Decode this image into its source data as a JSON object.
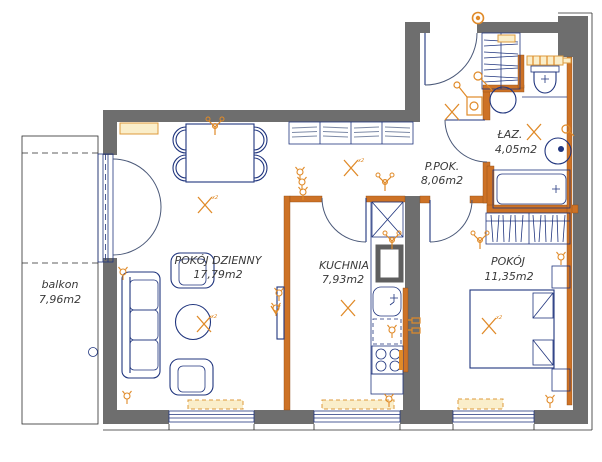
{
  "plan": {
    "title": "apartment-floor-plan",
    "rooms": [
      {
        "name": "POKÓJ DZIENNY",
        "area": "17,79m2"
      },
      {
        "name": "KUCHNIA",
        "area": "7,93m2"
      },
      {
        "name": "P.POK.",
        "area": "8,06m2"
      },
      {
        "name": "ŁAZ.",
        "area": "4,05m2"
      },
      {
        "name": "POKÓJ",
        "area": "11,35m2"
      },
      {
        "name": "balkon",
        "area": "7,96m2"
      }
    ],
    "lamp_label": "x2",
    "symbols": {
      "ceiling-lamp-icon": "orange X cross",
      "chandelier-icon": "orange pendant",
      "socket-icon": "orange wall socket",
      "entrance-lamp-icon": "orange double circle"
    },
    "colors": {
      "wall": "#6e6e6e",
      "interior_wall_accent": "#cd7226",
      "furniture_line": "#20357e",
      "electric_accent": "#e08a28",
      "radiator_fill": "#faeeca"
    }
  }
}
